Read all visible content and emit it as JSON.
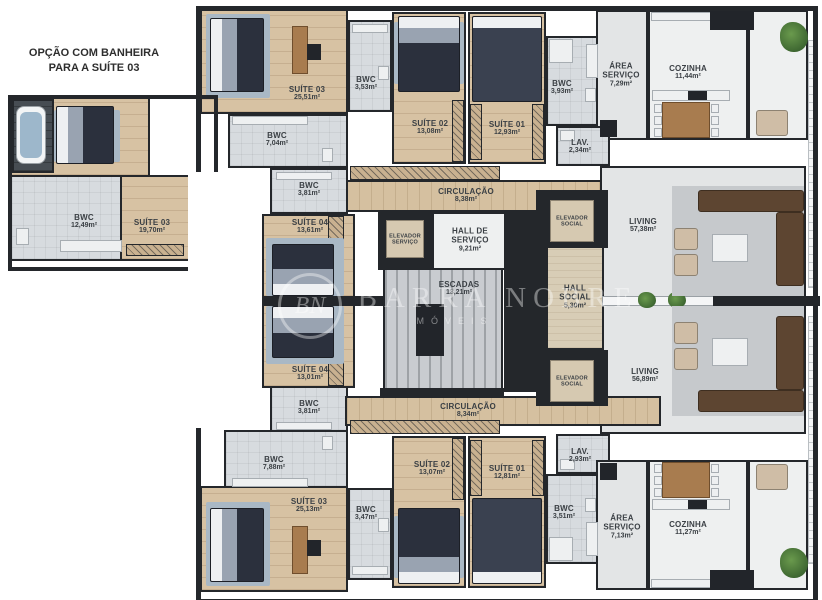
{
  "note": {
    "line1": "OPÇÃO COM BANHEIRA",
    "line2": "PARA A SUÍTE 03"
  },
  "detail_plan": {
    "bwc": {
      "name": "BWC",
      "area": "12,49m²"
    },
    "suite03": {
      "name": "SUÍTE 03",
      "area": "19,70m²"
    }
  },
  "upper_unit": {
    "suite03": {
      "name": "SUÍTE 03",
      "area": "25,51m²"
    },
    "bwc_suite03": {
      "name": "BWC",
      "area": "3,53m²"
    },
    "bwc_hall": {
      "name": "BWC",
      "area": "7,04m²"
    },
    "suite02": {
      "name": "SUÍTE 02",
      "area": "13,08m²"
    },
    "suite01": {
      "name": "SUÍTE 01",
      "area": "12,93m²"
    },
    "bwc_suites": {
      "name": "BWC",
      "area": "3,93m²"
    },
    "lav": {
      "name": "LAV.",
      "area": "2,34m²"
    },
    "area_servico": {
      "name": "ÁREA SERVIÇO",
      "area": "7,29m²"
    },
    "cozinha": {
      "name": "COZINHA",
      "area": "11,44m²"
    },
    "circulacao": {
      "name": "CIRCULAÇÃO",
      "area": "8,38m²"
    },
    "bwc_suite04": {
      "name": "BWC",
      "area": "3,81m²"
    },
    "suite04": {
      "name": "SUÍTE 04",
      "area": "13,61m²"
    },
    "living": {
      "name": "LIVING",
      "area": "57,38m²"
    }
  },
  "core": {
    "elevador_servico": {
      "name": "ELEVADOR SERVIÇO"
    },
    "hall_servico": {
      "name": "HALL DE SERVIÇO",
      "area": "9,21m²"
    },
    "escadas": {
      "name": "ESCADAS",
      "area": "13,21m²"
    },
    "hall_social": {
      "name": "HALL SOCIAL",
      "area": "5,30m²"
    },
    "elevador_social_sup": {
      "name": "ELEVADOR SOCIAL"
    },
    "elevador_social_inf": {
      "name": "ELEVADOR SOCIAL"
    }
  },
  "lower_unit": {
    "suite04": {
      "name": "SUÍTE 04",
      "area": "13,01m²"
    },
    "bwc_suite04": {
      "name": "BWC",
      "area": "3,81m²"
    },
    "circulacao": {
      "name": "CIRCULAÇÃO",
      "area": "8,34m²"
    },
    "bwc_hall": {
      "name": "BWC",
      "area": "7,88m²"
    },
    "suite03": {
      "name": "SUÍTE 03",
      "area": "25,13m²"
    },
    "bwc_suite03": {
      "name": "BWC",
      "area": "3,47m²"
    },
    "suite02": {
      "name": "SUÍTE 02",
      "area": "13,07m²"
    },
    "suite01": {
      "name": "SUÍTE 01",
      "area": "12,81m²"
    },
    "lav": {
      "name": "LAV.",
      "area": "2,93m²"
    },
    "bwc_suites": {
      "name": "BWC",
      "area": "3,51m²"
    },
    "area_servico": {
      "name": "ÁREA SERVIÇO",
      "area": "7,13m²"
    },
    "cozinha": {
      "name": "COZINHA",
      "area": "11,27m²"
    },
    "living": {
      "name": "LIVING",
      "area": "56,89m²"
    }
  },
  "watermark": {
    "monogram": "BN",
    "brand": "BARRA NOBRE",
    "subbrand": "MÓVEIS"
  },
  "palette": {
    "wall": "#24272b",
    "wood_floor": "#d7c2a3",
    "tile_floor": "#d7dbdf",
    "hall_beige": "#d8cdb6",
    "label_text": "#3b4045",
    "plant_green": "#5a8a42",
    "watermark_white": "rgba(255,255,255,0.40)"
  }
}
